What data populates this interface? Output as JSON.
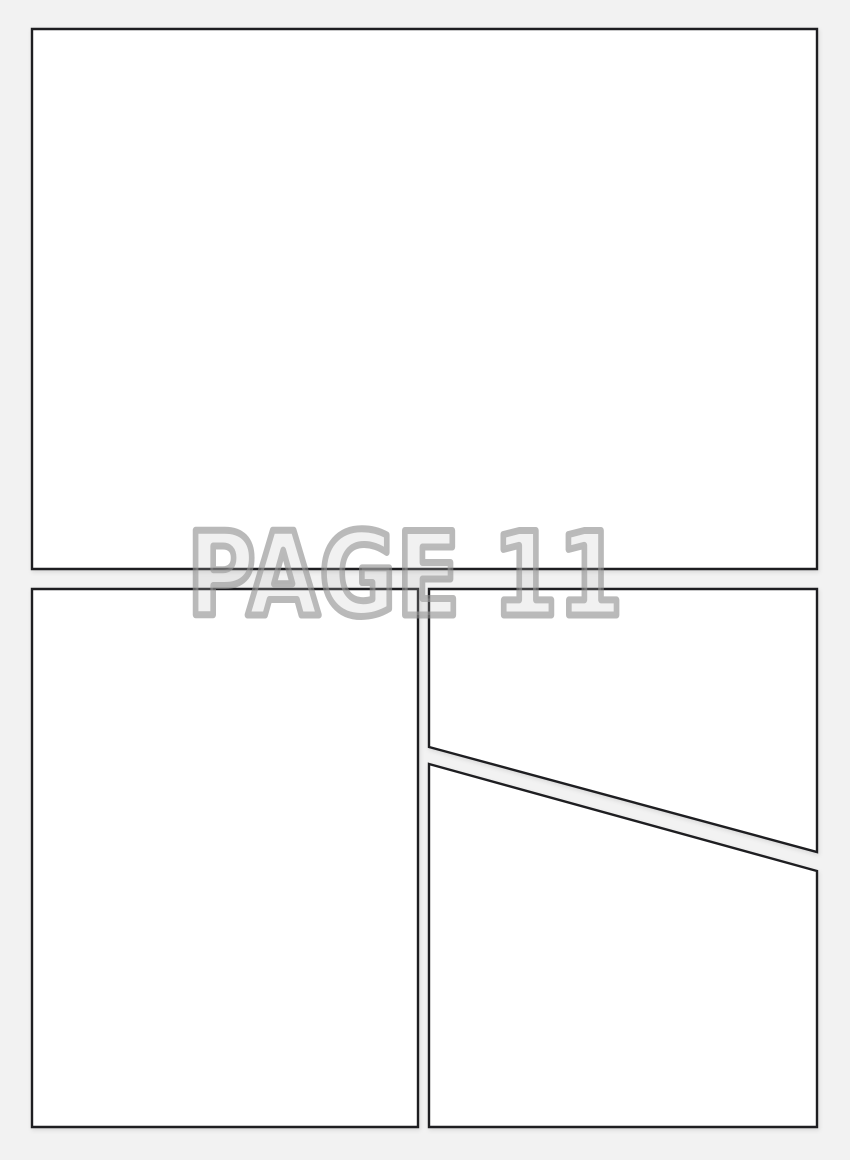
{
  "page": {
    "label": "PAGE 11",
    "colors": {
      "background": "#f2f2f2",
      "panel_fill": "#ffffff",
      "panel_border": "#1e1e21",
      "label_outline": "#8e8e8e",
      "label_outline_opacity": "0.62",
      "label_fill": "#bdbdbd",
      "label_fill_opacity": "0.22"
    },
    "panels": [
      {
        "id": "panel-top",
        "points": [
          [
            32,
            29
          ],
          [
            817,
            29
          ],
          [
            817,
            569
          ],
          [
            32,
            569
          ]
        ]
      },
      {
        "id": "panel-bottom-left",
        "points": [
          [
            32,
            589
          ],
          [
            418,
            589
          ],
          [
            418,
            1127
          ],
          [
            32,
            1127
          ]
        ]
      },
      {
        "id": "panel-bottom-right-upper",
        "points": [
          [
            429,
            589
          ],
          [
            817,
            589
          ],
          [
            817,
            852
          ],
          [
            429,
            747
          ]
        ]
      },
      {
        "id": "panel-bottom-right-lower",
        "points": [
          [
            429,
            764
          ],
          [
            817,
            871
          ],
          [
            817,
            1127
          ],
          [
            429,
            1127
          ]
        ]
      }
    ]
  }
}
